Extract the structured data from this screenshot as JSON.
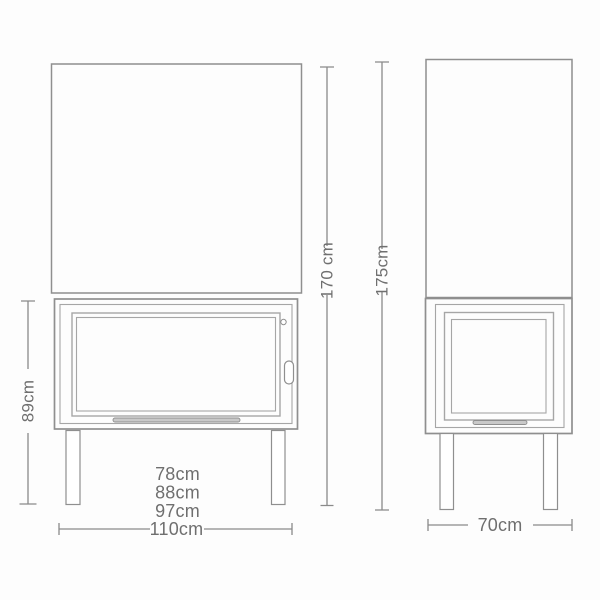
{
  "title": "fireplace-dimension-diagram",
  "colors": {
    "outline": "#8f8f8f",
    "outline_light": "#a6a6a6",
    "dimension": "#8a8a8a",
    "text": "#6f6f6f",
    "vent_fill": "#c9c9c9",
    "background": "#fdfdfd"
  },
  "labels": {
    "width_variant_1": "78cm",
    "width_variant_2": "88cm",
    "width_variant_3": "97cm",
    "overall_width": "110cm",
    "firebox_height": "89cm",
    "height_front": "170 cm",
    "height_total": "175cm",
    "depth": "70cm"
  }
}
